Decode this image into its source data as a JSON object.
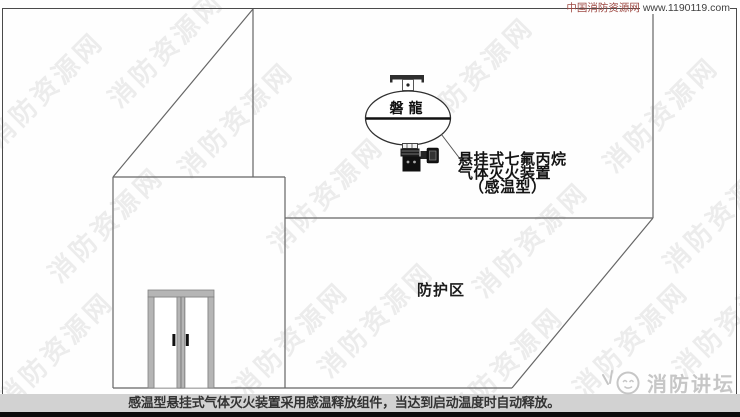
{
  "header": {
    "site_credit_cn": "中国消防资源网",
    "site_credit_url": "www.1190119.com"
  },
  "device": {
    "brand": "磐龍",
    "label_line1": "悬挂式七氟丙烷",
    "label_line2": "气体灭火装置",
    "label_line3": "（感温型）"
  },
  "room": {
    "zone_label": "防护区"
  },
  "caption": {
    "text": "感温型悬挂式气体灭火装置采用感温释放组件，当达到启动温度时自动释放。"
  },
  "footer_logo": {
    "name": "消防讲坛",
    "icon": "smiley-face-logo"
  },
  "watermark": {
    "text": "消防资源网"
  },
  "colors": {
    "accent_red": "#9f4a44",
    "line": "#666666",
    "caption_bg": "#d2d2d2",
    "caption_text": "#333333",
    "bottom_bar": "#0b0b0b",
    "watermark_gray": "#c5c5c5",
    "logo_gray": "#c6c6c6"
  }
}
